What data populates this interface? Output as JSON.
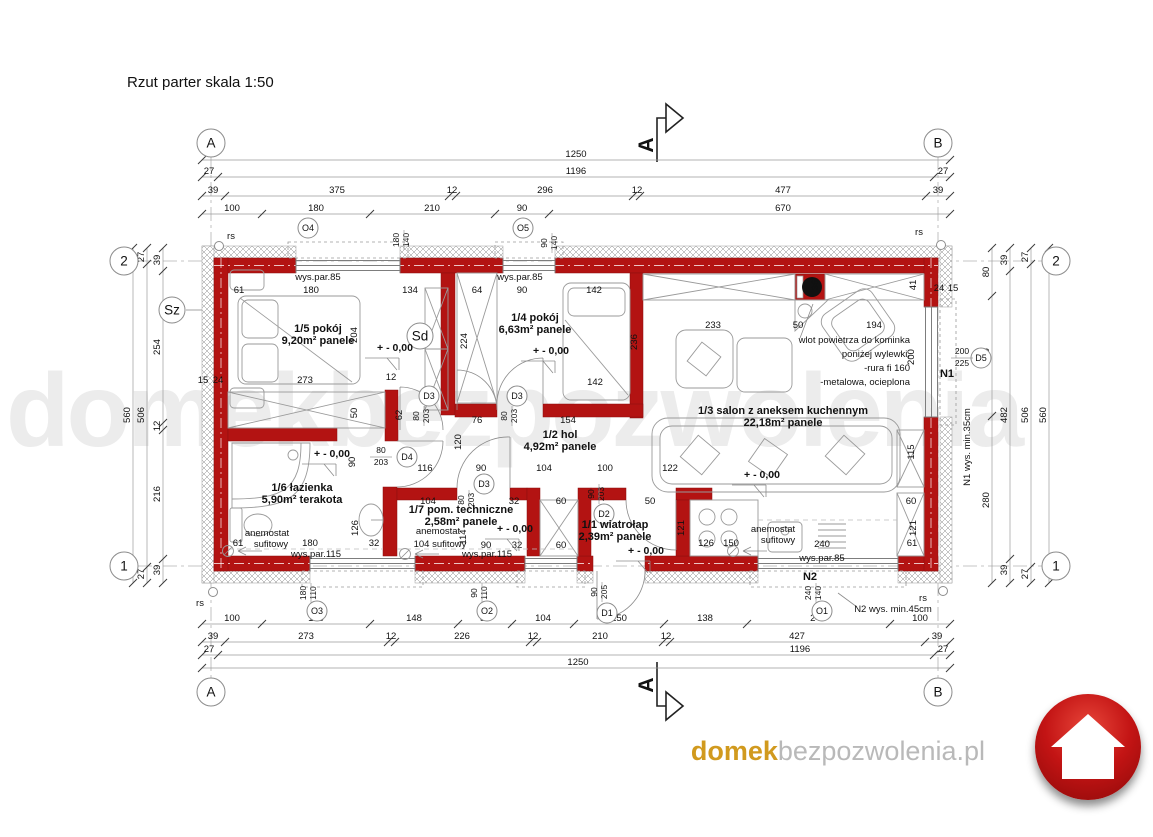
{
  "title": "Rzut parter skala 1:50",
  "watermark": "domekbezpozwolenia",
  "footer": {
    "domain_bold": "domek",
    "domain_rest": "bezpozwolenia.pl"
  },
  "palette": {
    "wall_red": "#b31312",
    "logo_red": "#c31414",
    "logo_gold": "#d19a1e",
    "logo_gray": "#b9b9b9",
    "watermark_gray": "#ececec"
  },
  "section_label": "A",
  "level_label": "+ - 0,00",
  "rooms": [
    {
      "id": "1/5",
      "name": "pokój",
      "area": "9,20m²",
      "finish": "panele",
      "lx": 318,
      "ly": 332
    },
    {
      "id": "1/4",
      "name": "pokój",
      "area": "6,63m²",
      "finish": "panele",
      "lx": 535,
      "ly": 321
    },
    {
      "id": "1/3",
      "name": "salon z aneksem kuchennym",
      "area": "22,18m²",
      "finish": "panele",
      "lx": 783,
      "ly": 414
    },
    {
      "id": "1/2",
      "name": "hol",
      "area": "4,92m²",
      "finish": "panele",
      "lx": 560,
      "ly": 438
    },
    {
      "id": "1/6",
      "name": "łazienka",
      "area": "5,90m²",
      "finish": "terakota",
      "lx": 302,
      "ly": 491
    },
    {
      "id": "1/7",
      "name": "pom. techniczne",
      "area": "2,58m²",
      "finish": "panele",
      "lx": 461,
      "ly": 513
    },
    {
      "id": "1/1",
      "name": "wiatrołap",
      "area": "2,39m²",
      "finish": "panele",
      "lx": 615,
      "ly": 528
    }
  ],
  "grid_markers": [
    {
      "t": "A",
      "x": 211,
      "y": 143,
      "r": 14
    },
    {
      "t": "B",
      "x": 938,
      "y": 143,
      "r": 14
    },
    {
      "t": "A",
      "x": 211,
      "y": 692,
      "r": 14
    },
    {
      "t": "B",
      "x": 938,
      "y": 692,
      "r": 14
    },
    {
      "t": "2",
      "x": 124,
      "y": 261,
      "r": 14
    },
    {
      "t": "1",
      "x": 124,
      "y": 566,
      "r": 14
    },
    {
      "t": "2",
      "x": 1056,
      "y": 261,
      "r": 14
    },
    {
      "t": "1",
      "x": 1056,
      "y": 566,
      "r": 14
    },
    {
      "t": "Sz",
      "x": 172,
      "y": 310,
      "r": 13
    },
    {
      "t": "Sd",
      "x": 420,
      "y": 336,
      "r": 13
    }
  ],
  "openings": [
    {
      "t": "O4",
      "cx": 308,
      "cy": 228,
      "f1": "180",
      "f2": "140",
      "fx": 404,
      "fy": 240,
      "rot": true
    },
    {
      "t": "O5",
      "cx": 523,
      "cy": 228,
      "f1": "90",
      "f2": "140",
      "fx": 552,
      "fy": 243,
      "rot": true
    },
    {
      "t": "O3",
      "cx": 317,
      "cy": 611,
      "f1": "180",
      "f2": "110",
      "fx": 311,
      "fy": 593,
      "rot": true
    },
    {
      "t": "O2",
      "cx": 487,
      "cy": 611,
      "f1": "90",
      "f2": "110",
      "fx": 482,
      "fy": 593,
      "rot": true
    },
    {
      "t": "D1",
      "cx": 607,
      "cy": 613,
      "f1": "90",
      "f2": "205",
      "fx": 602,
      "fy": 592,
      "rot": true
    },
    {
      "t": "O1",
      "cx": 822,
      "cy": 611,
      "f1": "240",
      "f2": "140",
      "fx": 816,
      "fy": 593,
      "rot": true
    },
    {
      "t": "D2",
      "cx": 604,
      "cy": 514,
      "f1": "90",
      "f2": "203",
      "fx": 599,
      "fy": 494,
      "rot": true
    },
    {
      "t": "D3",
      "cx": 429,
      "cy": 396,
      "f1": "80",
      "f2": "203",
      "fx": 424,
      "fy": 416,
      "rot": true
    },
    {
      "t": "D3",
      "cx": 517,
      "cy": 396,
      "f1": "80",
      "f2": "203",
      "fx": 512,
      "fy": 416,
      "rot": true
    },
    {
      "t": "D3",
      "cx": 484,
      "cy": 484,
      "f1": "80",
      "f2": "203",
      "fx": 469,
      "fy": 500,
      "rot": true
    },
    {
      "t": "D4",
      "cx": 407,
      "cy": 457,
      "f1": "80",
      "f2": "203",
      "fx": 381,
      "fy": 457,
      "rot": false
    },
    {
      "t": "D5",
      "cx": 981,
      "cy": 358,
      "f1": "200",
      "f2": "225",
      "fx": 962,
      "fy": 358,
      "rot": false
    }
  ],
  "dim_rows_h": [
    {
      "y": 160,
      "x1": 202,
      "x2": 950,
      "ticks": [
        202,
        950
      ],
      "labels": [
        {
          "t": "1250",
          "x": 576
        }
      ]
    },
    {
      "y": 177,
      "x1": 202,
      "x2": 950,
      "ticks": [
        202,
        218,
        934,
        950
      ],
      "labels": [
        {
          "t": "27",
          "x": 209
        },
        {
          "t": "1196",
          "x": 576
        },
        {
          "t": "27",
          "x": 943
        }
      ]
    },
    {
      "y": 196,
      "x1": 202,
      "x2": 950,
      "ticks": [
        202,
        225,
        449,
        456,
        633,
        640,
        926,
        950
      ],
      "labels": [
        {
          "t": "39",
          "x": 213
        },
        {
          "t": "375",
          "x": 337
        },
        {
          "t": "12",
          "x": 452
        },
        {
          "t": "296",
          "x": 545
        },
        {
          "t": "12",
          "x": 637
        },
        {
          "t": "477",
          "x": 783
        },
        {
          "t": "39",
          "x": 938
        }
      ]
    },
    {
      "y": 214,
      "x1": 202,
      "x2": 950,
      "ticks": [
        202,
        262,
        370,
        495,
        549,
        950
      ],
      "labels": [
        {
          "t": "100",
          "x": 232
        },
        {
          "t": "180",
          "x": 316
        },
        {
          "t": "210",
          "x": 432
        },
        {
          "t": "90",
          "x": 522
        },
        {
          "t": "670",
          "x": 783
        }
      ]
    },
    {
      "y": 624,
      "x1": 202,
      "x2": 950,
      "ticks": [
        202,
        262,
        370,
        458,
        512,
        574,
        664,
        747,
        890,
        950
      ],
      "labels": [
        {
          "t": "100",
          "x": 232
        },
        {
          "t": "180",
          "x": 316
        },
        {
          "t": "148",
          "x": 414
        },
        {
          "t": "90",
          "x": 485
        },
        {
          "t": "104",
          "x": 543
        },
        {
          "t": "150",
          "x": 619
        },
        {
          "t": "138",
          "x": 705
        },
        {
          "t": "240",
          "x": 818
        },
        {
          "t": "100",
          "x": 920
        }
      ]
    },
    {
      "y": 642,
      "x1": 202,
      "x2": 950,
      "ticks": [
        202,
        225,
        388,
        395,
        530,
        537,
        663,
        670,
        925,
        950
      ],
      "labels": [
        {
          "t": "39",
          "x": 213
        },
        {
          "t": "273",
          "x": 306
        },
        {
          "t": "12",
          "x": 391
        },
        {
          "t": "226",
          "x": 462
        },
        {
          "t": "12",
          "x": 533
        },
        {
          "t": "210",
          "x": 600
        },
        {
          "t": "12",
          "x": 666
        },
        {
          "t": "427",
          "x": 797
        },
        {
          "t": "39",
          "x": 937
        }
      ]
    },
    {
      "y": 655,
      "x1": 202,
      "x2": 950,
      "ticks": [
        202,
        218,
        934,
        950
      ],
      "labels": [
        {
          "t": "27",
          "x": 209
        },
        {
          "t": "1196",
          "x": 800
        },
        {
          "t": "27",
          "x": 943
        }
      ]
    },
    {
      "y": 668,
      "x1": 202,
      "x2": 950,
      "ticks": [
        202,
        950
      ],
      "labels": [
        {
          "t": "1250",
          "x": 578
        }
      ]
    }
  ],
  "dim_rows_v": [
    {
      "x": 133,
      "y1": 248,
      "y2": 583,
      "ticks": [
        248,
        583
      ],
      "labels": [
        {
          "t": "560",
          "y": 415
        }
      ]
    },
    {
      "x": 147,
      "y1": 248,
      "y2": 583,
      "ticks": [
        248,
        264,
        567,
        583
      ],
      "labels": [
        {
          "t": "27",
          "y": 257
        },
        {
          "t": "506",
          "y": 415
        },
        {
          "t": "27",
          "y": 574
        }
      ]
    },
    {
      "x": 163,
      "y1": 248,
      "y2": 583,
      "ticks": [
        248,
        271,
        423,
        430,
        559,
        583
      ],
      "labels": [
        {
          "t": "39",
          "y": 260
        },
        {
          "t": "254",
          "y": 347
        },
        {
          "t": "12",
          "y": 426
        },
        {
          "t": "216",
          "y": 494
        },
        {
          "t": "39",
          "y": 570
        }
      ]
    },
    {
      "x": 992,
      "y1": 248,
      "y2": 583,
      "ticks": [
        248,
        296,
        416,
        583
      ],
      "labels": [
        {
          "t": "80",
          "y": 272
        },
        {
          "t": "200",
          "y": 356
        },
        {
          "t": "280",
          "y": 500
        }
      ]
    },
    {
      "x": 1010,
      "y1": 248,
      "y2": 583,
      "ticks": [
        248,
        271,
        559,
        583
      ],
      "labels": [
        {
          "t": "39",
          "y": 260
        },
        {
          "t": "482",
          "y": 415
        },
        {
          "t": "39",
          "y": 570
        }
      ]
    },
    {
      "x": 1031,
      "y1": 248,
      "y2": 583,
      "ticks": [
        248,
        264,
        567,
        583
      ],
      "labels": [
        {
          "t": "27",
          "y": 257
        },
        {
          "t": "506",
          "y": 415
        },
        {
          "t": "27",
          "y": 574
        }
      ]
    },
    {
      "x": 1049,
      "y1": 248,
      "y2": 583,
      "ticks": [
        248,
        583
      ],
      "labels": [
        {
          "t": "560",
          "y": 415
        }
      ]
    }
  ],
  "free_dims": [
    {
      "t": "61",
      "x": 239,
      "y": 293
    },
    {
      "t": "180",
      "x": 311,
      "y": 293
    },
    {
      "t": "134",
      "x": 410,
      "y": 293
    },
    {
      "t": "64",
      "x": 477,
      "y": 293
    },
    {
      "t": "90",
      "x": 522,
      "y": 293
    },
    {
      "t": "142",
      "x": 594,
      "y": 293
    },
    {
      "t": "233",
      "x": 713,
      "y": 328
    },
    {
      "t": "50",
      "x": 798,
      "y": 328
    },
    {
      "t": "194",
      "x": 874,
      "y": 328
    },
    {
      "t": "36",
      "x": 818,
      "y": 285,
      "r": true
    },
    {
      "t": "41",
      "x": 916,
      "y": 285,
      "r": true
    },
    {
      "t": "204",
      "x": 357,
      "y": 335,
      "r": true
    },
    {
      "t": "224",
      "x": 467,
      "y": 341,
      "r": true
    },
    {
      "t": "236",
      "x": 637,
      "y": 342,
      "r": true
    },
    {
      "t": "273",
      "x": 305,
      "y": 383
    },
    {
      "t": "12",
      "x": 391,
      "y": 380
    },
    {
      "t": "142",
      "x": 595,
      "y": 385
    },
    {
      "t": "50",
      "x": 357,
      "y": 413,
      "r": true
    },
    {
      "t": "62",
      "x": 402,
      "y": 415,
      "r": true
    },
    {
      "t": "76",
      "x": 477,
      "y": 423
    },
    {
      "t": "154",
      "x": 568,
      "y": 423
    },
    {
      "t": "120",
      "x": 461,
      "y": 442,
      "r": true
    },
    {
      "t": "116",
      "x": 425,
      "y": 471
    },
    {
      "t": "90",
      "x": 481,
      "y": 471
    },
    {
      "t": "104",
      "x": 544,
      "y": 471
    },
    {
      "t": "100",
      "x": 605,
      "y": 471
    },
    {
      "t": "122",
      "x": 670,
      "y": 471
    },
    {
      "t": "90",
      "x": 355,
      "y": 462,
      "r": true
    },
    {
      "t": "115",
      "x": 914,
      "y": 452,
      "r": true
    },
    {
      "t": "200",
      "x": 914,
      "y": 357,
      "r": true
    },
    {
      "t": "61",
      "x": 238,
      "y": 546
    },
    {
      "t": "180",
      "x": 310,
      "y": 546
    },
    {
      "t": "32",
      "x": 374,
      "y": 546
    },
    {
      "t": "126",
      "x": 358,
      "y": 528,
      "r": true
    },
    {
      "t": "104",
      "x": 428,
      "y": 504
    },
    {
      "t": "32",
      "x": 514,
      "y": 504
    },
    {
      "t": "60",
      "x": 561,
      "y": 504
    },
    {
      "t": "114",
      "x": 466,
      "y": 537,
      "r": true
    },
    {
      "t": "90",
      "x": 486,
      "y": 548
    },
    {
      "t": "32",
      "x": 517,
      "y": 548
    },
    {
      "t": "60",
      "x": 561,
      "y": 548
    },
    {
      "t": "50",
      "x": 650,
      "y": 504
    },
    {
      "t": "121",
      "x": 684,
      "y": 528,
      "r": true
    },
    {
      "t": "150",
      "x": 731,
      "y": 546
    },
    {
      "t": "60",
      "x": 911,
      "y": 504
    },
    {
      "t": "121",
      "x": 916,
      "y": 528,
      "r": true
    },
    {
      "t": "61",
      "x": 912,
      "y": 546
    },
    {
      "t": "126",
      "x": 706,
      "y": 546
    },
    {
      "t": "240",
      "x": 822,
      "y": 547
    },
    {
      "t": "15",
      "x": 203,
      "y": 383
    },
    {
      "t": "24",
      "x": 218,
      "y": 383
    },
    {
      "t": "24",
      "x": 939,
      "y": 291
    },
    {
      "t": "15",
      "x": 953,
      "y": 291
    }
  ],
  "annotations": [
    {
      "t": "wys.par.85",
      "x": 318,
      "y": 280
    },
    {
      "t": "wys.par.85",
      "x": 520,
      "y": 280
    },
    {
      "t": "wys.par.85",
      "x": 822,
      "y": 561
    },
    {
      "t": "wys.par.115",
      "x": 316,
      "y": 557
    },
    {
      "t": "wys.par.115",
      "x": 487,
      "y": 557
    },
    {
      "t": "anemostat",
      "x": 267,
      "y": 536
    },
    {
      "t": "sufitowy",
      "x": 271,
      "y": 547
    },
    {
      "t": "anemostat",
      "x": 438,
      "y": 534
    },
    {
      "t": "104 sufitowy",
      "x": 440,
      "y": 547
    },
    {
      "t": "anemostat",
      "x": 773,
      "y": 532
    },
    {
      "t": "sufitowy",
      "x": 778,
      "y": 543
    },
    {
      "t": "N1",
      "x": 947,
      "y": 377,
      "bold": true
    },
    {
      "t": "N2",
      "x": 810,
      "y": 580,
      "bold": true
    },
    {
      "t": "N1 wys. min.35cm",
      "x": 970,
      "y": 447,
      "r": true
    },
    {
      "t": "N2 wys. min.45cm",
      "x": 893,
      "y": 612
    },
    {
      "t": "rs",
      "x": 231,
      "y": 239
    },
    {
      "t": "rs",
      "x": 919,
      "y": 235
    },
    {
      "t": "rs",
      "x": 200,
      "y": 606
    },
    {
      "t": "rs",
      "x": 923,
      "y": 601
    },
    {
      "t": "wlot powietrza do kominka",
      "x": 910,
      "y": 343,
      "align": "end"
    },
    {
      "t": "poniżej wylewki,",
      "x": 910,
      "y": 357,
      "align": "end"
    },
    {
      "t": "-rura fi 160",
      "x": 910,
      "y": 371,
      "align": "end"
    },
    {
      "t": "-metalowa, ocieplona",
      "x": 910,
      "y": 385,
      "align": "end"
    }
  ],
  "level_marks": [
    {
      "x": 395,
      "y": 351
    },
    {
      "x": 551,
      "y": 354
    },
    {
      "x": 332,
      "y": 457
    },
    {
      "x": 762,
      "y": 478
    },
    {
      "x": 646,
      "y": 554
    },
    {
      "x": 515,
      "y": 532
    }
  ],
  "rs_circles": [
    {
      "x": 219,
      "y": 246
    },
    {
      "x": 941,
      "y": 245
    },
    {
      "x": 213,
      "y": 592
    },
    {
      "x": 943,
      "y": 591
    }
  ]
}
